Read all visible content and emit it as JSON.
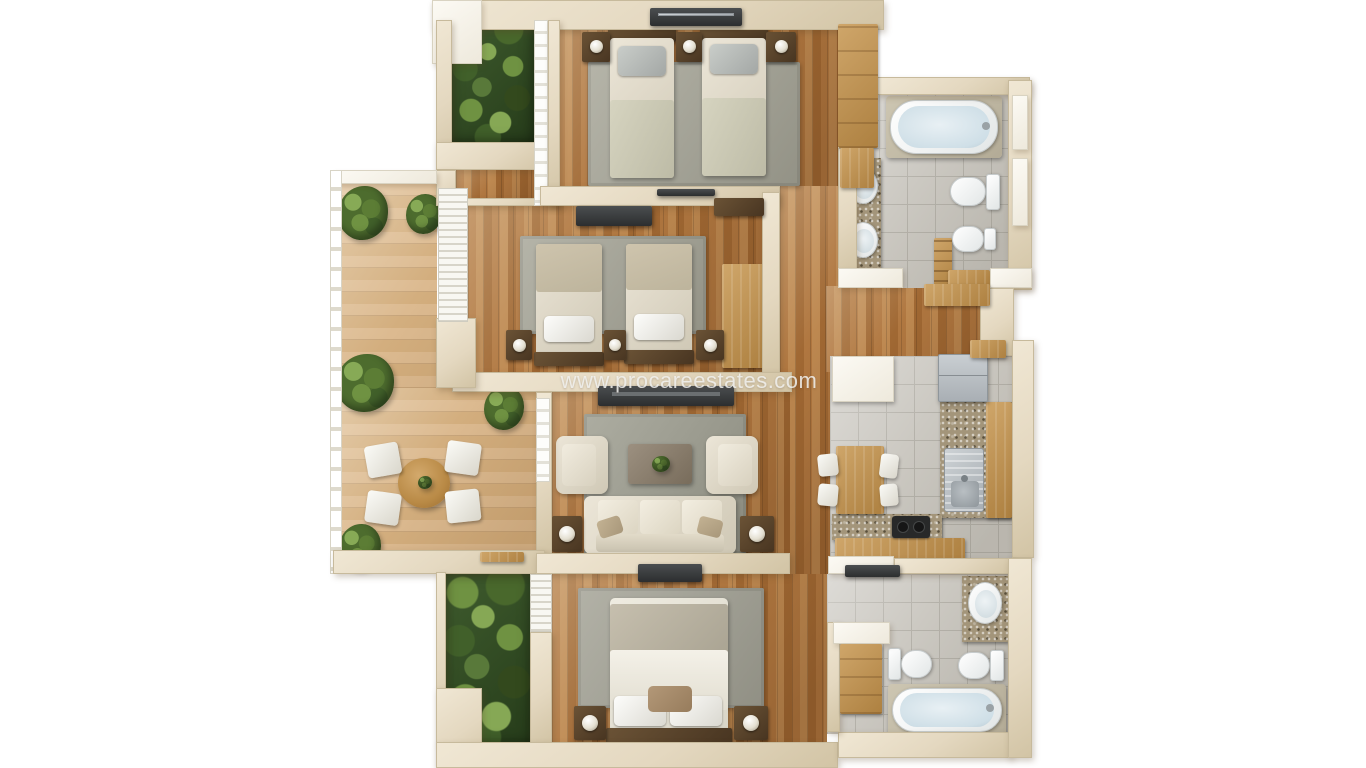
{
  "watermark": {
    "text": "www.procareestates.com"
  },
  "palette": {
    "bg": "#ffffff",
    "wall": "#e7dcc7",
    "wall_white": "#f5f1e6",
    "wood": "#ad7440",
    "terrace": "#dab78c",
    "tile": "#cbc8c1",
    "granite": "#a3957a",
    "rug": "#9d9d8f",
    "cream_furniture": "#ddd6c5",
    "dark_wood": "#53402b",
    "tv_dark": "#3a3d3f",
    "white_fixture": "#f3f5f5",
    "water": "#d9e6ec",
    "plant_green": "#4d6c2e",
    "steel": "#b7bcc0",
    "light_wood": "#c49a5d"
  },
  "plan": {
    "type": "3d-rendered-floor-plan-top-view",
    "rooms": [
      {
        "id": "bedroom-top",
        "label": "twin bedroom",
        "furniture": [
          "single-bed",
          "single-bed",
          "nightstand-with-lamp",
          "nightstand-with-lamp",
          "nightstand-with-lamp",
          "area-rug",
          "wardrobe",
          "window"
        ]
      },
      {
        "id": "bedroom-middle",
        "label": "twin bedroom",
        "furniture": [
          "single-bed",
          "single-bed",
          "nightstand-with-lamp",
          "nightstand-with-lamp",
          "nightstand-with-lamp",
          "area-rug",
          "tv-console",
          "sideboard",
          "desk",
          "louvered-window"
        ]
      },
      {
        "id": "living-room",
        "label": "living room",
        "furniture": [
          "sofa",
          "armchair",
          "armchair",
          "coffee-table-with-plant",
          "tv-console",
          "side-table-with-lamp",
          "side-table-with-lamp",
          "area-rug"
        ]
      },
      {
        "id": "master-bedroom",
        "label": "master bedroom",
        "furniture": [
          "double-bed",
          "nightstand-with-lamp",
          "nightstand-with-lamp",
          "area-rug",
          "tv-console",
          "louvered-window"
        ]
      },
      {
        "id": "terrace",
        "label": "terrace",
        "furniture": [
          "round-table",
          "chair",
          "chair",
          "chair",
          "chair",
          "potted-plant",
          "potted-plant",
          "potted-plant",
          "potted-plant",
          "potted-plant",
          "doormat",
          "railing"
        ]
      },
      {
        "id": "bathroom-top",
        "label": "bathroom",
        "furniture": [
          "bathtub",
          "washbasin",
          "washbasin",
          "toilet",
          "bidet",
          "vanity-counter",
          "towel-rack"
        ]
      },
      {
        "id": "kitchen",
        "label": "kitchen",
        "furniture": [
          "dining-table",
          "chair",
          "chair",
          "chair",
          "chair",
          "refrigerator",
          "sink",
          "cooktop",
          "granite-counter",
          "upper-cabinets"
        ]
      },
      {
        "id": "bathroom-bottom",
        "label": "bathroom",
        "furniture": [
          "bathtub",
          "washbasin",
          "toilet",
          "bidet",
          "wardrobe",
          "vanity-counter"
        ]
      },
      {
        "id": "hallway",
        "label": "hallway",
        "furniture": [
          "console-table",
          "console-table"
        ]
      },
      {
        "id": "garden-top",
        "label": "planted patio"
      },
      {
        "id": "garden-bottom",
        "label": "planted patio"
      }
    ]
  }
}
